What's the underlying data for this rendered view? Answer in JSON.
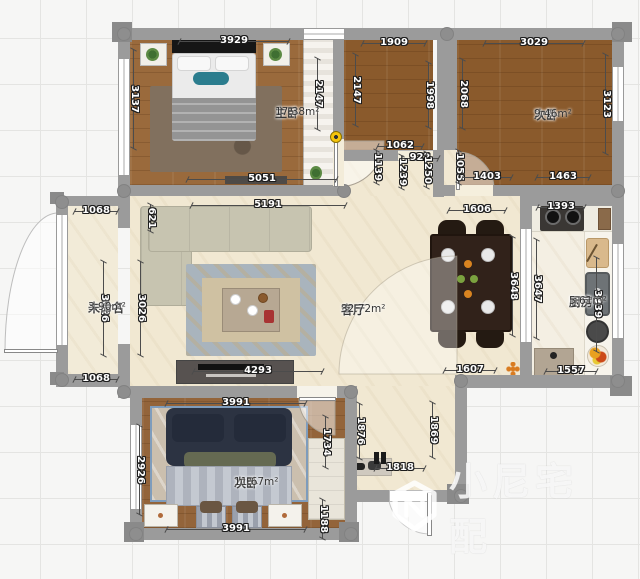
{
  "plan": {
    "watermark": {
      "text": "小尼宅配",
      "logo_icon": "cube-n-logo-icon"
    },
    "rooms": [
      {
        "name": "主卧",
        "area": "17.38m²",
        "x": 275,
        "y": 106
      },
      {
        "name": "次卧",
        "area": "9.46m²",
        "x": 534,
        "y": 108
      },
      {
        "name": "客厅",
        "area": "32.72m²",
        "x": 341,
        "y": 303
      },
      {
        "name": "未命名",
        "area": "3.90m²",
        "x": 88,
        "y": 301
      },
      {
        "name": "厨房",
        "area": "5.61m²",
        "x": 569,
        "y": 295
      },
      {
        "name": "次卧",
        "area": "11.67m²",
        "x": 234,
        "y": 476
      }
    ],
    "dimensions": [
      {
        "text": "3929",
        "x": 234,
        "y": 41,
        "o": "h",
        "len": 110
      },
      {
        "text": "1909",
        "x": 394,
        "y": 43,
        "o": "h",
        "len": 64
      },
      {
        "text": "3029",
        "x": 534,
        "y": 43,
        "o": "h",
        "len": 100
      },
      {
        "text": "3137",
        "x": 134,
        "y": 99,
        "o": "v",
        "len": 100
      },
      {
        "text": "2147",
        "x": 318,
        "y": 94,
        "o": "v",
        "len": 72
      },
      {
        "text": "2147",
        "x": 356,
        "y": 90,
        "o": "v",
        "len": 72
      },
      {
        "text": "1998",
        "x": 429,
        "y": 95,
        "o": "v",
        "len": 66
      },
      {
        "text": "2068",
        "x": 463,
        "y": 94,
        "o": "v",
        "len": 70
      },
      {
        "text": "3123",
        "x": 606,
        "y": 104,
        "o": "v",
        "len": 100
      },
      {
        "text": "5051",
        "x": 262,
        "y": 179,
        "o": "h",
        "len": 150
      },
      {
        "text": "1062",
        "x": 400,
        "y": 146,
        "o": "h",
        "len": 46
      },
      {
        "text": "922",
        "x": 420,
        "y": 158,
        "o": "h",
        "len": 38
      },
      {
        "text": "1139",
        "x": 377,
        "y": 167,
        "o": "v",
        "len": 34
      },
      {
        "text": "1239",
        "x": 402,
        "y": 172,
        "o": "v",
        "len": 34
      },
      {
        "text": "1250",
        "x": 427,
        "y": 170,
        "o": "v",
        "len": 36
      },
      {
        "text": "1055",
        "x": 459,
        "y": 167,
        "o": "v",
        "len": 34
      },
      {
        "text": "1403",
        "x": 487,
        "y": 177,
        "o": "h",
        "len": 50
      },
      {
        "text": "1463",
        "x": 563,
        "y": 177,
        "o": "h",
        "len": 54
      },
      {
        "text": "1068",
        "x": 96,
        "y": 211,
        "o": "h",
        "len": 44
      },
      {
        "text": "621",
        "x": 151,
        "y": 218,
        "o": "v",
        "len": 28
      },
      {
        "text": "5191",
        "x": 268,
        "y": 205,
        "o": "h",
        "len": 155
      },
      {
        "text": "1606",
        "x": 477,
        "y": 210,
        "o": "h",
        "len": 58
      },
      {
        "text": "1393",
        "x": 561,
        "y": 207,
        "o": "h",
        "len": 48
      },
      {
        "text": "3026",
        "x": 104,
        "y": 308,
        "o": "v",
        "len": 95
      },
      {
        "text": "3026",
        "x": 141,
        "y": 308,
        "o": "v",
        "len": 95
      },
      {
        "text": "3648",
        "x": 513,
        "y": 286,
        "o": "v",
        "len": 100
      },
      {
        "text": "3647",
        "x": 537,
        "y": 289,
        "o": "v",
        "len": 100
      },
      {
        "text": "3339",
        "x": 597,
        "y": 304,
        "o": "v",
        "len": 95
      },
      {
        "text": "1068",
        "x": 96,
        "y": 379,
        "o": "h",
        "len": 44
      },
      {
        "text": "4293",
        "x": 258,
        "y": 371,
        "o": "h",
        "len": 130
      },
      {
        "text": "1607",
        "x": 470,
        "y": 370,
        "o": "h",
        "len": 52
      },
      {
        "text": "1557",
        "x": 571,
        "y": 371,
        "o": "h",
        "len": 52
      },
      {
        "text": "3991",
        "x": 236,
        "y": 403,
        "o": "h",
        "len": 140
      },
      {
        "text": "1734",
        "x": 326,
        "y": 442,
        "o": "v",
        "len": 52
      },
      {
        "text": "1876",
        "x": 360,
        "y": 431,
        "o": "v",
        "len": 56
      },
      {
        "text": "1869",
        "x": 433,
        "y": 430,
        "o": "v",
        "len": 56
      },
      {
        "text": "2926",
        "x": 140,
        "y": 470,
        "o": "v",
        "len": 90
      },
      {
        "text": "1818",
        "x": 400,
        "y": 468,
        "o": "h",
        "len": 50
      },
      {
        "text": "1188",
        "x": 323,
        "y": 519,
        "o": "v",
        "len": 40
      },
      {
        "text": "3991",
        "x": 236,
        "y": 529,
        "o": "h",
        "len": 140
      }
    ],
    "colors": {
      "wall": "#9b9b9b",
      "wood_master": "#9a6a3c",
      "wood_dark": "#8a5a2c",
      "wood_bottom": "#93643a",
      "floor_cream": "#f1e8d2",
      "hinge_marker": "#f6c50b",
      "accent_teal": "#2b7d8e",
      "bed_navy": "#2c3342"
    }
  }
}
